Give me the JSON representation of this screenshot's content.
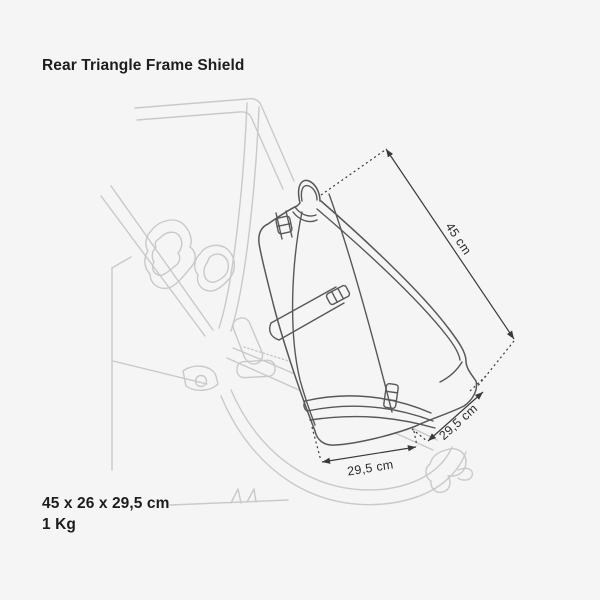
{
  "product": {
    "title": "Rear Triangle Frame Shield",
    "dimensions_text": "45 x 26 x 29,5 cm",
    "weight_text": "1 Kg"
  },
  "diagram": {
    "dimension_labels": {
      "height": "45 cm",
      "depth": "29,5 cm",
      "width": "29,5 cm"
    }
  },
  "colors": {
    "background": "#f5f5f6",
    "bike_line": "#c9c9cb",
    "bag_line": "#58585a",
    "dimension_line": "#3a3a3c",
    "text": "#1d1d1f"
  }
}
